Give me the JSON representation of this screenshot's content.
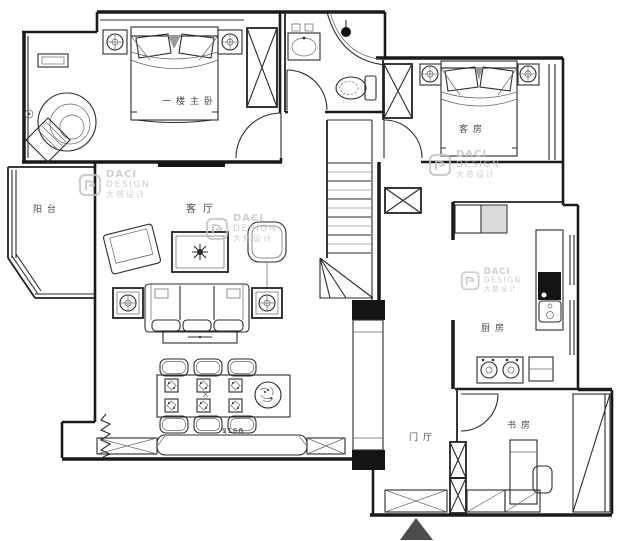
{
  "plan": {
    "rooms": {
      "master_bedroom": {
        "label": "一楼主卧"
      },
      "balcony": {
        "label": "阳台"
      },
      "living_room": {
        "label": "客厅"
      },
      "guest_room": {
        "label": "客房"
      },
      "kitchen": {
        "label": "厨房"
      },
      "hallway": {
        "label": "门厅"
      },
      "study": {
        "label": "书房"
      }
    },
    "annotations": {
      "cabinet_dimension": "3160"
    },
    "watermark": {
      "brand": "DACI",
      "word": "DESIGN",
      "chinese": "大慈设计"
    },
    "colors": {
      "line": "#1a1a1a",
      "label": "#4a4a4a",
      "watermark": "#c2c2c2",
      "background": "#ffffff"
    }
  }
}
